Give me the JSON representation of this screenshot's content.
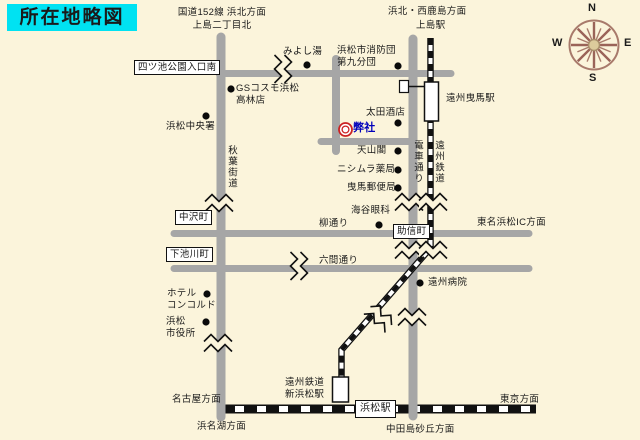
{
  "title": "所在地略図",
  "compass": {
    "n": "N",
    "e": "E",
    "s": "S",
    "w": "W"
  },
  "directions": {
    "route152_north": "国道152線 浜北方面",
    "kamijima2_north": "上島二丁目北",
    "hamakita_nishikajima": "浜北・西鹿島方面",
    "tomei_ic": "東名浜松IC方面",
    "nagoya": "名古屋方面",
    "hamanako": "浜名湖方面",
    "tokyo": "東京方面",
    "nakatajima": "中田島砂丘方面"
  },
  "stations": {
    "kamijima": "上島駅",
    "enshu_hikuma": "遠州曳馬駅",
    "shin_hamamatsu": "遠州鉄道\n新浜松駅",
    "hamamatsu": "浜松駅"
  },
  "roads": {
    "akiha_kaido": "秋葉街道",
    "densha_dori": "電車通り",
    "enshu_tetsudo": "遠州鉄道",
    "yanagi_dori": "柳通り",
    "rokken_dori": "六間通り"
  },
  "intersections": {
    "yotsuike": "四ツ池公園入口南",
    "nakazawa": "中沢町",
    "shimoikegawa": "下池川町",
    "sukenobu": "助信町"
  },
  "pois": {
    "miyoshiyu": "みよし湯",
    "shobodan": "浜松市消防団\n第九分団",
    "gs_cosmo": "GSコスモ浜松\n高林店",
    "chuo_sho": "浜松中央署",
    "ota_saketen": "太田酒店",
    "heisha": "弊社",
    "tenzankaku": "天山閣",
    "nishimura": "ニシムラ薬局",
    "hikuma_yubin": "曳馬郵便局",
    "kaiya_ganka": "海谷眼科",
    "enshu_byoin": "遠州病院",
    "hotel_concorde": "ホテル\nコンコルド",
    "shiyakusho": "浜松\n市役所"
  },
  "colors": {
    "background": "#FBF4DB",
    "road": "#A6A6A6",
    "title_bg": "#00E2F2",
    "company_text": "#0000BB",
    "company_mark": "#CC2222",
    "compass": "#9A6358"
  }
}
